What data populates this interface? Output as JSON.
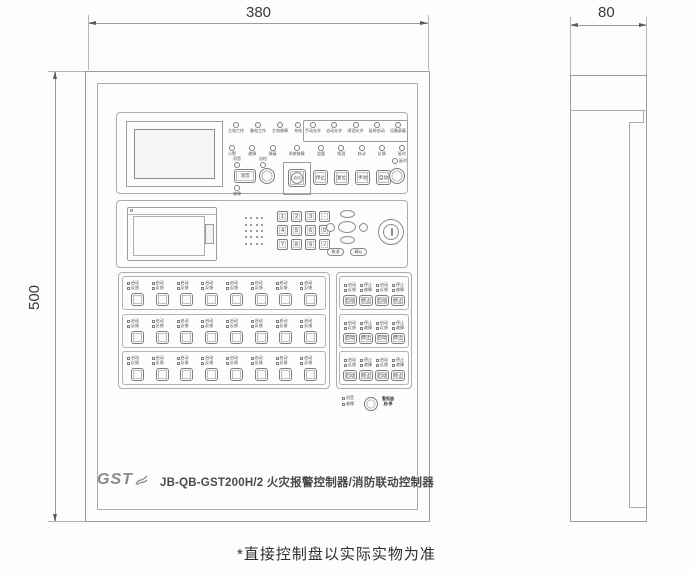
{
  "caption": "*直接控制盘以实际实物为准",
  "dimensions": {
    "front_width": "380",
    "front_height": "500",
    "side_depth": "80"
  },
  "brand": {
    "logo_text": "GST",
    "model_label": "JB-QB-GST200H/2 火灾报警控制器/消防联动控制器"
  },
  "colors": {
    "line": "#9b9b9b",
    "line_light": "#b3b3b3",
    "text": "#3a3a3a",
    "background": "#fdfdfd"
  },
  "top_panel": {
    "row1_indicators": [
      "主电工作",
      "备电工作",
      "主电故障",
      "充电"
    ],
    "row1_boxed_indicators": [
      "手动允许",
      "自动允许",
      "喷洒允许",
      "延时启动",
      "设备屏蔽"
    ],
    "row2_indicators": [
      "火警",
      "故障",
      "屏蔽",
      "系统故障",
      "监管",
      "喷洒",
      "启动",
      "反馈",
      "延时"
    ],
    "buttons": {
      "mute": {
        "led_top": "消音",
        "label": "消音",
        "led_bottom": "故障"
      },
      "self_test": {
        "led_top": "自检"
      },
      "start_boxed": {
        "label": "启动"
      },
      "squares": [
        "停止",
        "复位",
        "手动",
        "自动"
      ],
      "delay": {
        "led_top": "延时"
      }
    }
  },
  "middle_panel": {
    "keypad_keys": [
      "1",
      "2",
      "3",
      "-",
      "4",
      "5",
      "6",
      "0",
      "7",
      "8",
      "9",
      "√"
    ],
    "soft_buttons": [
      "取消",
      "确认"
    ]
  },
  "direct_panel": {
    "rows": 3,
    "cols": 8,
    "led_labels": [
      "启动",
      "反馈"
    ]
  },
  "multiline_panel": {
    "rows": 3,
    "buttons": [
      {
        "label": "启动",
        "leds": [
          "启动",
          "反馈"
        ]
      },
      {
        "label": "停止",
        "leds": [
          "停止",
          "故障"
        ]
      },
      {
        "label": "启动",
        "leds": [
          "启动",
          "反馈"
        ]
      },
      {
        "label": "停止",
        "leds": [
          "停止",
          "故障"
        ]
      }
    ]
  },
  "alarm_cluster": {
    "leds": [
      "消音",
      "故障"
    ],
    "label_lines": [
      "警报器",
      "启/停"
    ]
  }
}
